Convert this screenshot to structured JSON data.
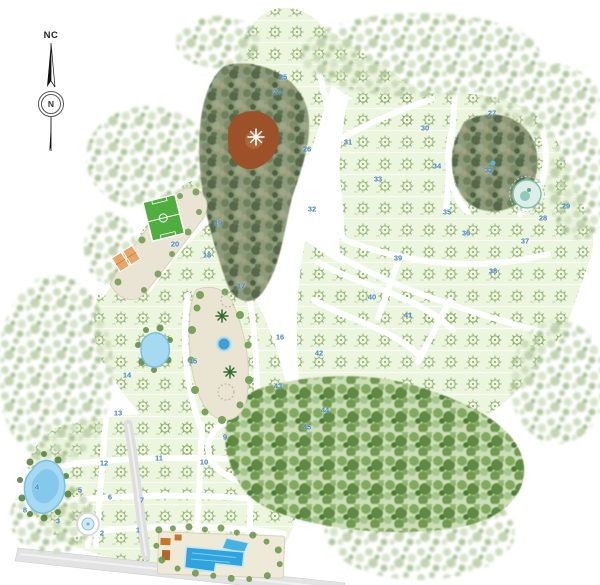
{
  "compass": {
    "label": "NC",
    "north_letter": "N"
  },
  "map": {
    "block_numbers": [
      {
        "n": "1",
        "x": 138,
        "y": 530
      },
      {
        "n": "2",
        "x": 102,
        "y": 533
      },
      {
        "n": "3",
        "x": 58,
        "y": 521
      },
      {
        "n": "4",
        "x": 37,
        "y": 487
      },
      {
        "n": "5",
        "x": 80,
        "y": 490
      },
      {
        "n": "6",
        "x": 110,
        "y": 497
      },
      {
        "n": "7",
        "x": 142,
        "y": 500
      },
      {
        "n": "8",
        "x": 25,
        "y": 510
      },
      {
        "n": "9",
        "x": 225,
        "y": 437
      },
      {
        "n": "10",
        "x": 204,
        "y": 462
      },
      {
        "n": "11",
        "x": 159,
        "y": 458
      },
      {
        "n": "12",
        "x": 104,
        "y": 463
      },
      {
        "n": "13",
        "x": 118,
        "y": 413
      },
      {
        "n": "14",
        "x": 127,
        "y": 375
      },
      {
        "n": "15",
        "x": 193,
        "y": 361
      },
      {
        "n": "16",
        "x": 280,
        "y": 337
      },
      {
        "n": "17",
        "x": 241,
        "y": 286
      },
      {
        "n": "18",
        "x": 207,
        "y": 255
      },
      {
        "n": "19",
        "x": 218,
        "y": 223
      },
      {
        "n": "20",
        "x": 175,
        "y": 244
      },
      {
        "n": "24",
        "x": 277,
        "y": 92
      },
      {
        "n": "25",
        "x": 283,
        "y": 77
      },
      {
        "n": "26",
        "x": 307,
        "y": 149
      },
      {
        "n": "27",
        "x": 492,
        "y": 113
      },
      {
        "n": "28",
        "x": 543,
        "y": 218
      },
      {
        "n": "29",
        "x": 566,
        "y": 206
      },
      {
        "n": "30",
        "x": 425,
        "y": 128
      },
      {
        "n": "31",
        "x": 348,
        "y": 142
      },
      {
        "n": "32",
        "x": 312,
        "y": 209
      },
      {
        "n": "32",
        "x": 489,
        "y": 170
      },
      {
        "n": "33",
        "x": 378,
        "y": 179
      },
      {
        "n": "34",
        "x": 437,
        "y": 166
      },
      {
        "n": "35",
        "x": 447,
        "y": 212
      },
      {
        "n": "36",
        "x": 466,
        "y": 233
      },
      {
        "n": "37",
        "x": 525,
        "y": 241
      },
      {
        "n": "38",
        "x": 493,
        "y": 271
      },
      {
        "n": "39",
        "x": 398,
        "y": 258
      },
      {
        "n": "40",
        "x": 372,
        "y": 297
      },
      {
        "n": "41",
        "x": 408,
        "y": 315
      },
      {
        "n": "42",
        "x": 319,
        "y": 353
      },
      {
        "n": "43",
        "x": 278,
        "y": 386
      },
      {
        "n": "44",
        "x": 325,
        "y": 410
      },
      {
        "n": "45",
        "x": 307,
        "y": 427
      }
    ],
    "colors": {
      "background": "#ffffff",
      "lot_area": "#ecf5dd",
      "block_number_blue": "#3e86c6",
      "road_white": "#ffffff",
      "road_paved_gray": "#e3e3e3",
      "soccer_field_green": "#4fae3d",
      "court_orange": "#e8a668",
      "water_blue": "#2fa3dc",
      "lake_blue": "#a6d9f2",
      "forest_mottle": "#8d9b7a",
      "clearing_brown": "#9c5128",
      "fringe_sage": "#c6d6b4",
      "teal_pond_ring": "#7fc0b1",
      "park_cream": "#eae4d2"
    }
  }
}
